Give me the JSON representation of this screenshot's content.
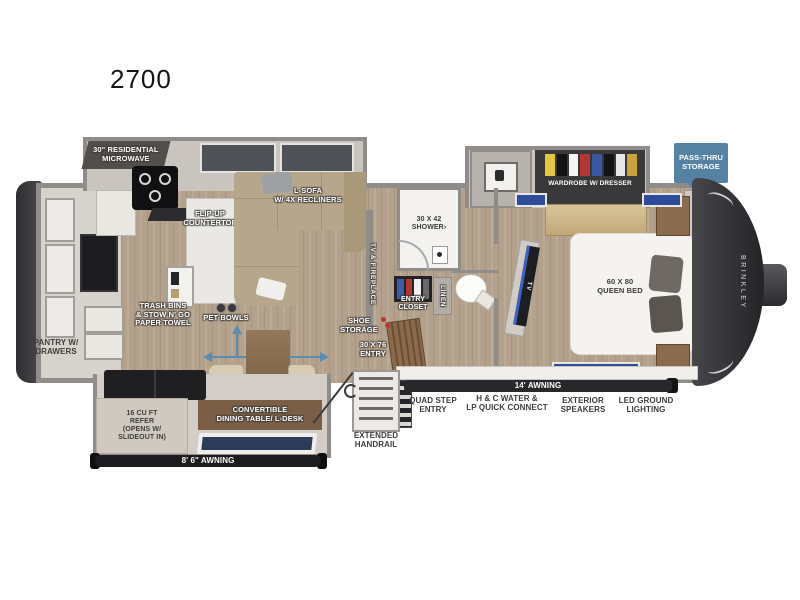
{
  "title": "2700",
  "brand_vertical": "BRINKLEY",
  "colors": {
    "callout_blue": "#5581a3",
    "arrow_blue": "#5b8cb2",
    "window_blue": "#2c3c58",
    "awning_black": "#1c1c1f",
    "wall_gray": "#908c89"
  },
  "callouts": {
    "pass_thru": [
      "PASS-THRU",
      "STORAGE"
    ]
  },
  "labels": {
    "microwave": [
      "30\" RESIDENTIAL",
      "MICROWAVE"
    ],
    "l_sofa": [
      "L-SOFA",
      "w/ 4x RECLINERS"
    ],
    "flip_up": [
      "FLIP-UP",
      "COUNTERTOP"
    ],
    "trash": [
      "TRASH BINS",
      "& STOW N' GO",
      "PAPER TOWEL"
    ],
    "pet_bowls": "PET BOWLS",
    "pantry": [
      "PANTRY w/",
      "DRAWERS"
    ],
    "refer": [
      "16 CU FT",
      "REFER",
      "(OPENS w/",
      "SLIDEOUT IN)"
    ],
    "dining": [
      "CONVERTIBLE",
      "DINING TABLE/ L-DESK"
    ],
    "awning_rear": "8' 6\" AWNING",
    "tv_fireplace": "TV & FIREPLACE",
    "shoe": [
      "SHOE",
      "STORAGE"
    ],
    "entry_door": [
      "30 X 76",
      "ENTRY"
    ],
    "handrail": [
      "EXTENDED",
      "HANDRAIL"
    ],
    "shower": [
      "30 x 42",
      "SHOWER›"
    ],
    "entry_closet": [
      "ENTRY",
      "CLOSET"
    ],
    "linen": "LINEN",
    "wardrobe": "WARDROBE w/ DRESSER",
    "queen_bed": [
      "60 x 80",
      "QUEEN BED"
    ],
    "tv": "TV",
    "awning_main": "14' AWNING",
    "features": [
      [
        "QUAD STEP",
        "ENTRY"
      ],
      [
        "H & C WATER &",
        "LP QUICK CONNECT"
      ],
      [
        "EXTERIOR",
        "SPEAKERS"
      ],
      [
        "LED GROUND",
        "LIGHTING"
      ]
    ]
  }
}
